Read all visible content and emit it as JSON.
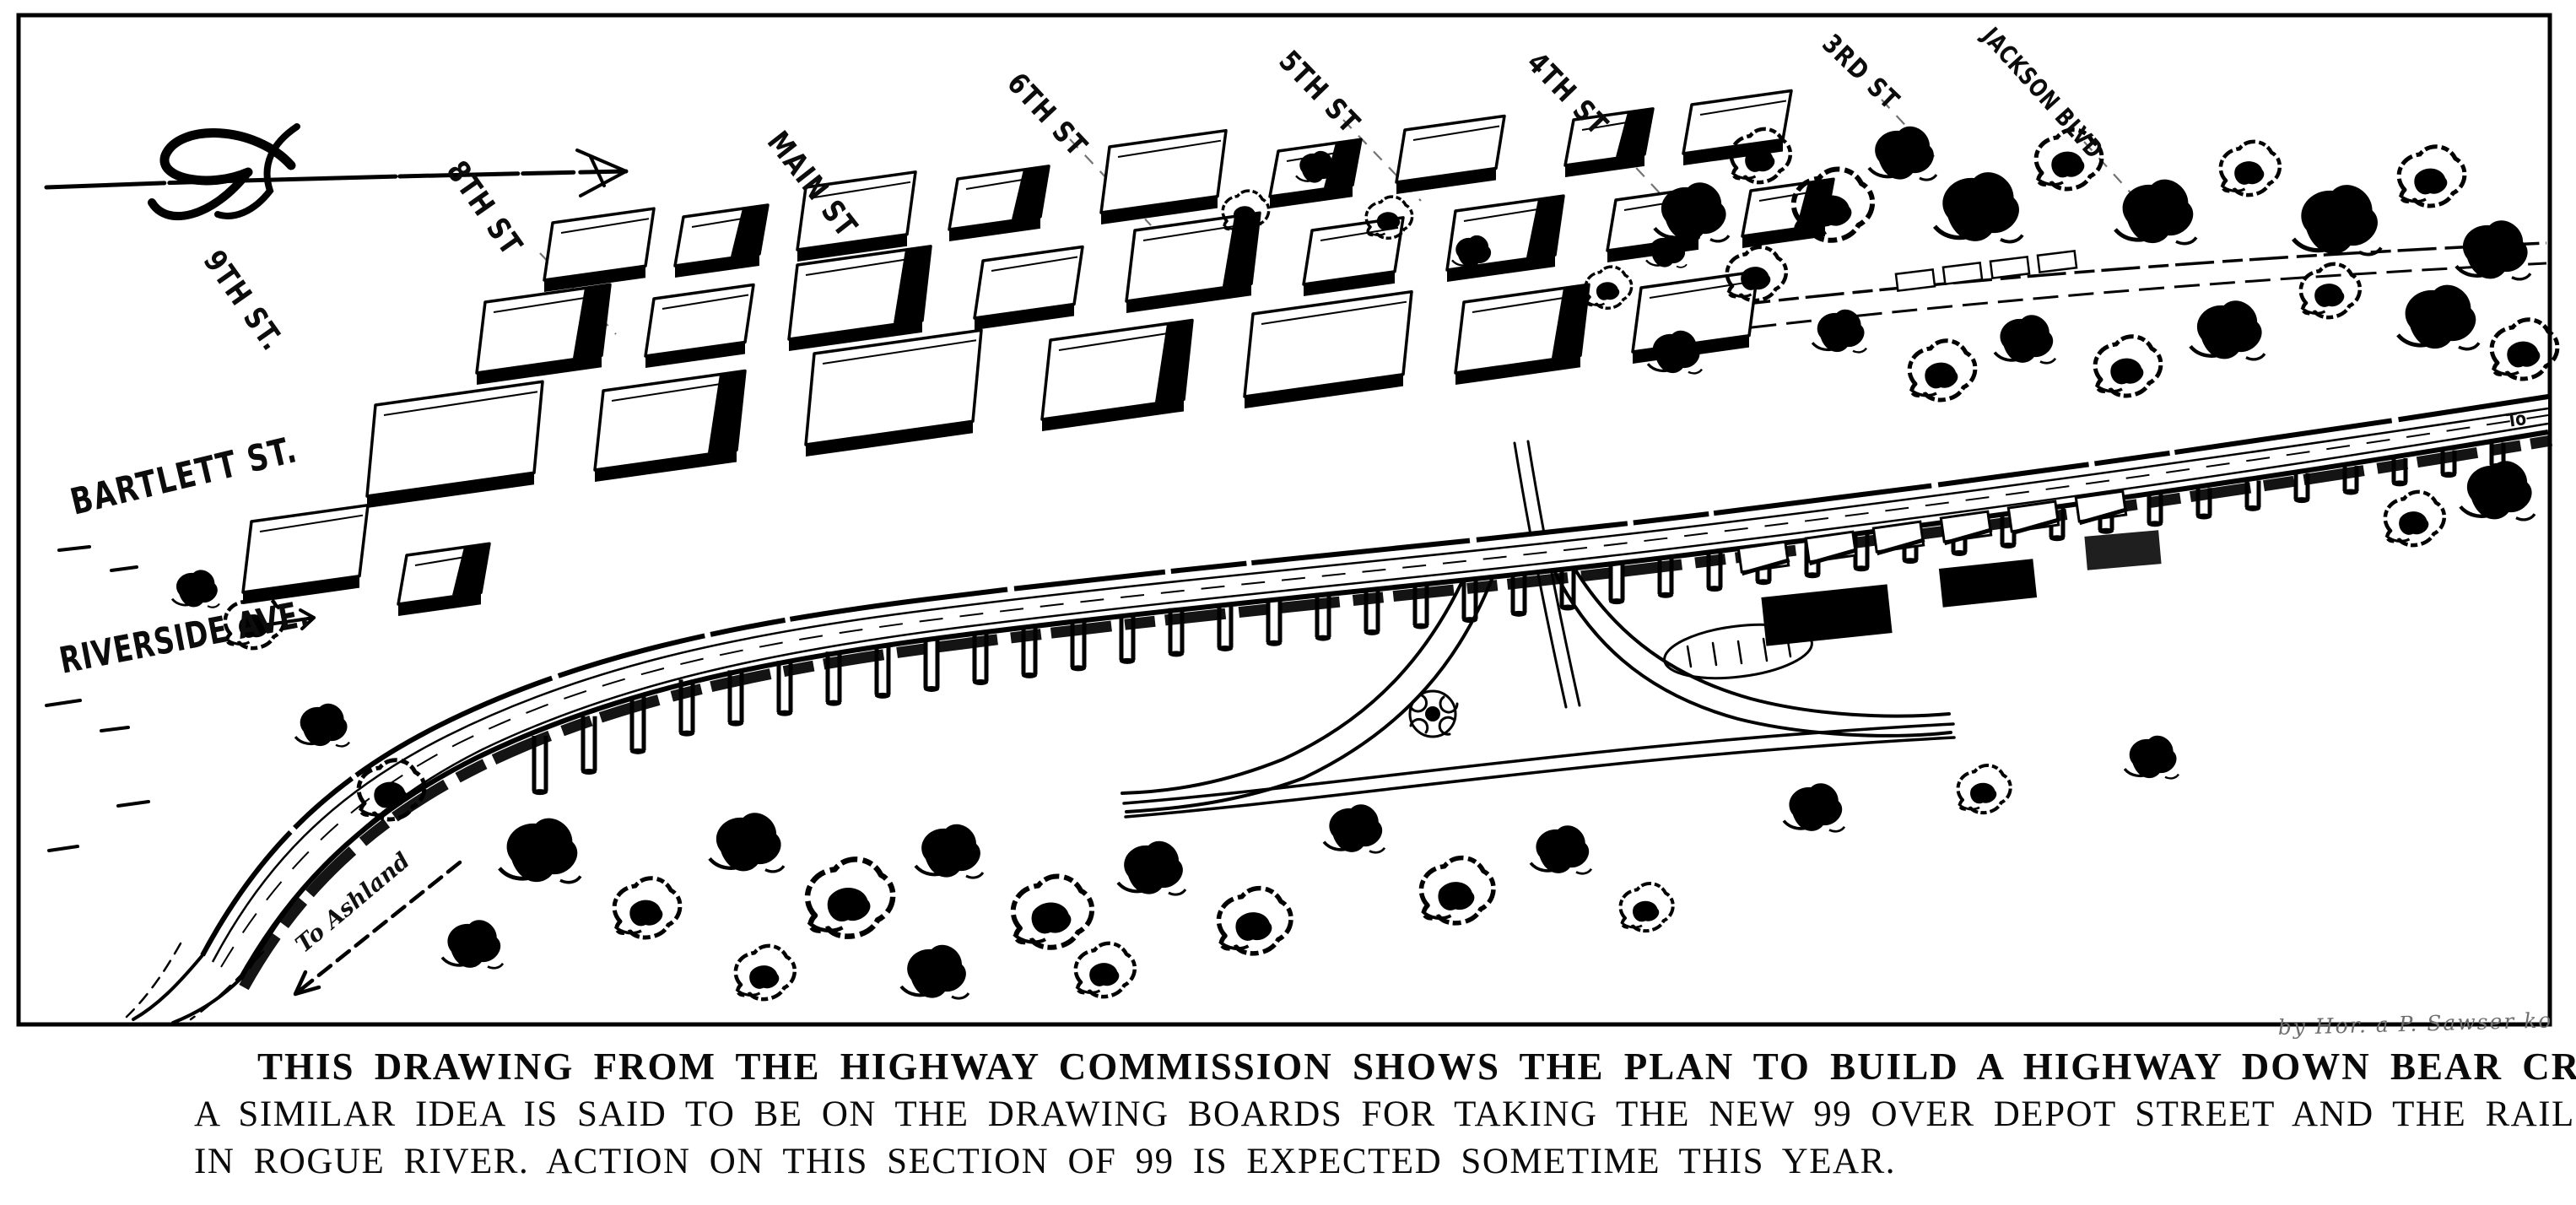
{
  "map": {
    "labels": {
      "street_9th": "9TH ST.",
      "street_8th": "8TH ST",
      "street_main": "MAIN ST",
      "street_6th": "6TH ST",
      "street_5th": "5TH ST",
      "street_4th": "4TH ST",
      "street_3rd": "3RD ST",
      "jackson_blvd": "JACKSON BLVD",
      "bartlett": "BARTLETT ST.",
      "riverside": "RIVERSIDE AVE.",
      "to_ashland": "To Ashland",
      "to_edge": "To",
      "signature": "by Hor. a P. Sawser  ko"
    }
  },
  "caption": {
    "line1": "THIS DRAWING FROM THE HIGHWAY COMMISSION SHOWS THE PLAN TO BUILD A HIGHWAY DOWN BEAR CREEK ON ''STILTS''.",
    "line2": "A SIMILAR IDEA IS SAID TO BE ON THE DRAWING BOARDS FOR TAKING THE NEW 99 OVER DEPOT STREET AND THE RAILROAD TRACKS",
    "line3": "IN ROGUE RIVER. ACTION ON THIS SECTION OF 99 IS EXPECTED SOMETIME THIS YEAR."
  }
}
